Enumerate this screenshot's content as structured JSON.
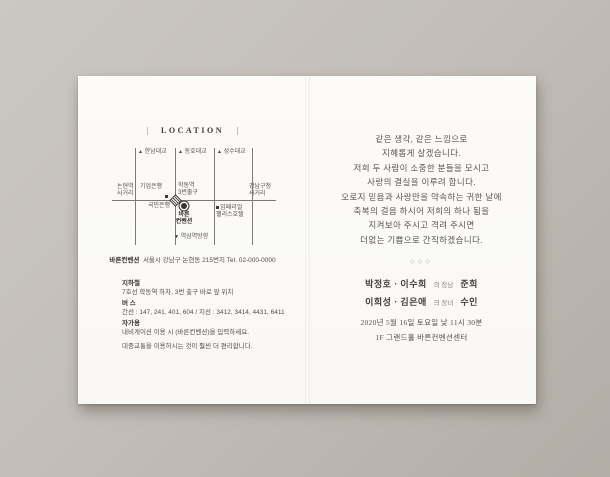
{
  "colors": {
    "background": "#c0bbb4",
    "card": "#fbfaf6",
    "ink_dark": "#37332f",
    "ink_body": "#55504b",
    "divider": "#b5aea6"
  },
  "left_page": {
    "header": {
      "left_bar": "|",
      "title": "LOCATION",
      "right_bar": "|"
    },
    "map": {
      "bridges": [
        {
          "icon": "▲",
          "label": "한남대교"
        },
        {
          "icon": "▲",
          "label": "동호대교"
        },
        {
          "icon": "▲",
          "label": "성수대교"
        }
      ],
      "nonhyeon": {
        "line1": "논현역",
        "line2": "사거리"
      },
      "ibk_bank": {
        "label": "기업은행"
      },
      "hakdong": {
        "line1": "학동역",
        "line2": "3번출구"
      },
      "gangnam_office": {
        "line1": "강남구청",
        "line2": "사거리"
      },
      "kb_bank": {
        "label": "국민은행"
      },
      "venue": {
        "line1": "바른",
        "line2": "컨벤션"
      },
      "imperial_hotel": {
        "line1": "임페리얼",
        "line2": "팰리스호텔"
      },
      "yeoksam": {
        "icon": "▼",
        "label": "역삼역방향"
      }
    },
    "address": {
      "name": "바른컨벤션",
      "detail": "서울시 강남구 논현동 215번지 Tel. 02-000-0000"
    },
    "transit": {
      "subway_title": "지하철",
      "subway_desc": "7호선 학동역 하차, 3번 출구 바로 앞 위치",
      "bus_title": "버 스",
      "bus_desc": "간선 : 147, 241, 401, 604 / 지선 : 3412, 3414, 4431, 6411",
      "car_title": "자가용",
      "car_desc": "내비게이션 이용 시 (바른컨벤션)을 입력하세요.",
      "note": "대중교통을 이용하시는 것이 훨씬 더 편리합니다."
    }
  },
  "right_page": {
    "greeting_lines": [
      "같은 생각, 같은 느낌으로",
      "지혜롭게 살겠습니다.",
      "저희 두 사람이 소중한 분들을 모시고",
      "사랑의 결실을 이루려 합니다.",
      "오로지 믿음과 사랑만을 약속하는 귀한 날에",
      "축복의 걸음 하시어 저희의 하나 됨을",
      "지켜보아 주시고 격려 주시면",
      "더없는 기쁨으로 간직하겠습니다."
    ],
    "divider": "◇◇◇",
    "family": [
      {
        "parents": "박정호 · 이수희",
        "relation": "의 장남",
        "name": "준희"
      },
      {
        "parents": "이희성 · 김은애",
        "relation": "의 장녀",
        "name": "수인"
      }
    ],
    "datetime": "2020년 5월 16일 토요일 낮 11시 30분",
    "venue": "1F 그랜드홀 바른컨벤션센터"
  }
}
